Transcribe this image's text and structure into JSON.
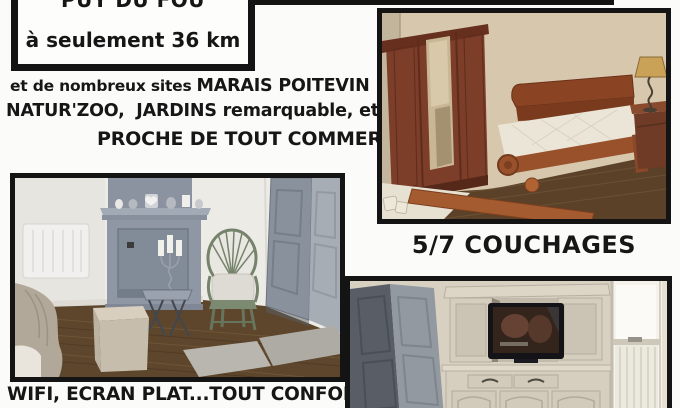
{
  "badge": {
    "title": "PUY DU FOU",
    "subtitle": "à seulement 36 km"
  },
  "description": {
    "line1_small": "et de nombreux sites",
    "line1_caps": "MARAIS POITEVIN",
    "line2": "NATUR'ZOO,  JARDINS remarquable, etc",
    "line3": "PROCHE DE TOUT COMMERCE"
  },
  "captions": {
    "sleeps": "5/7 COUCHAGES",
    "comfort": "WIFI, ECRAN PLAT...TOUT CONFORT"
  },
  "icons": {
    "watermark": "dice-cubes-watermark"
  },
  "colors": {
    "frame": "#141414",
    "text": "#161616",
    "background": "#fbfbfa",
    "bedroom_wall": "#d7c7ad",
    "wood_furniture": "#7c3d29",
    "fireplace_gray": "#8e97a3",
    "cabinet_cream": "#d6cfc0"
  }
}
